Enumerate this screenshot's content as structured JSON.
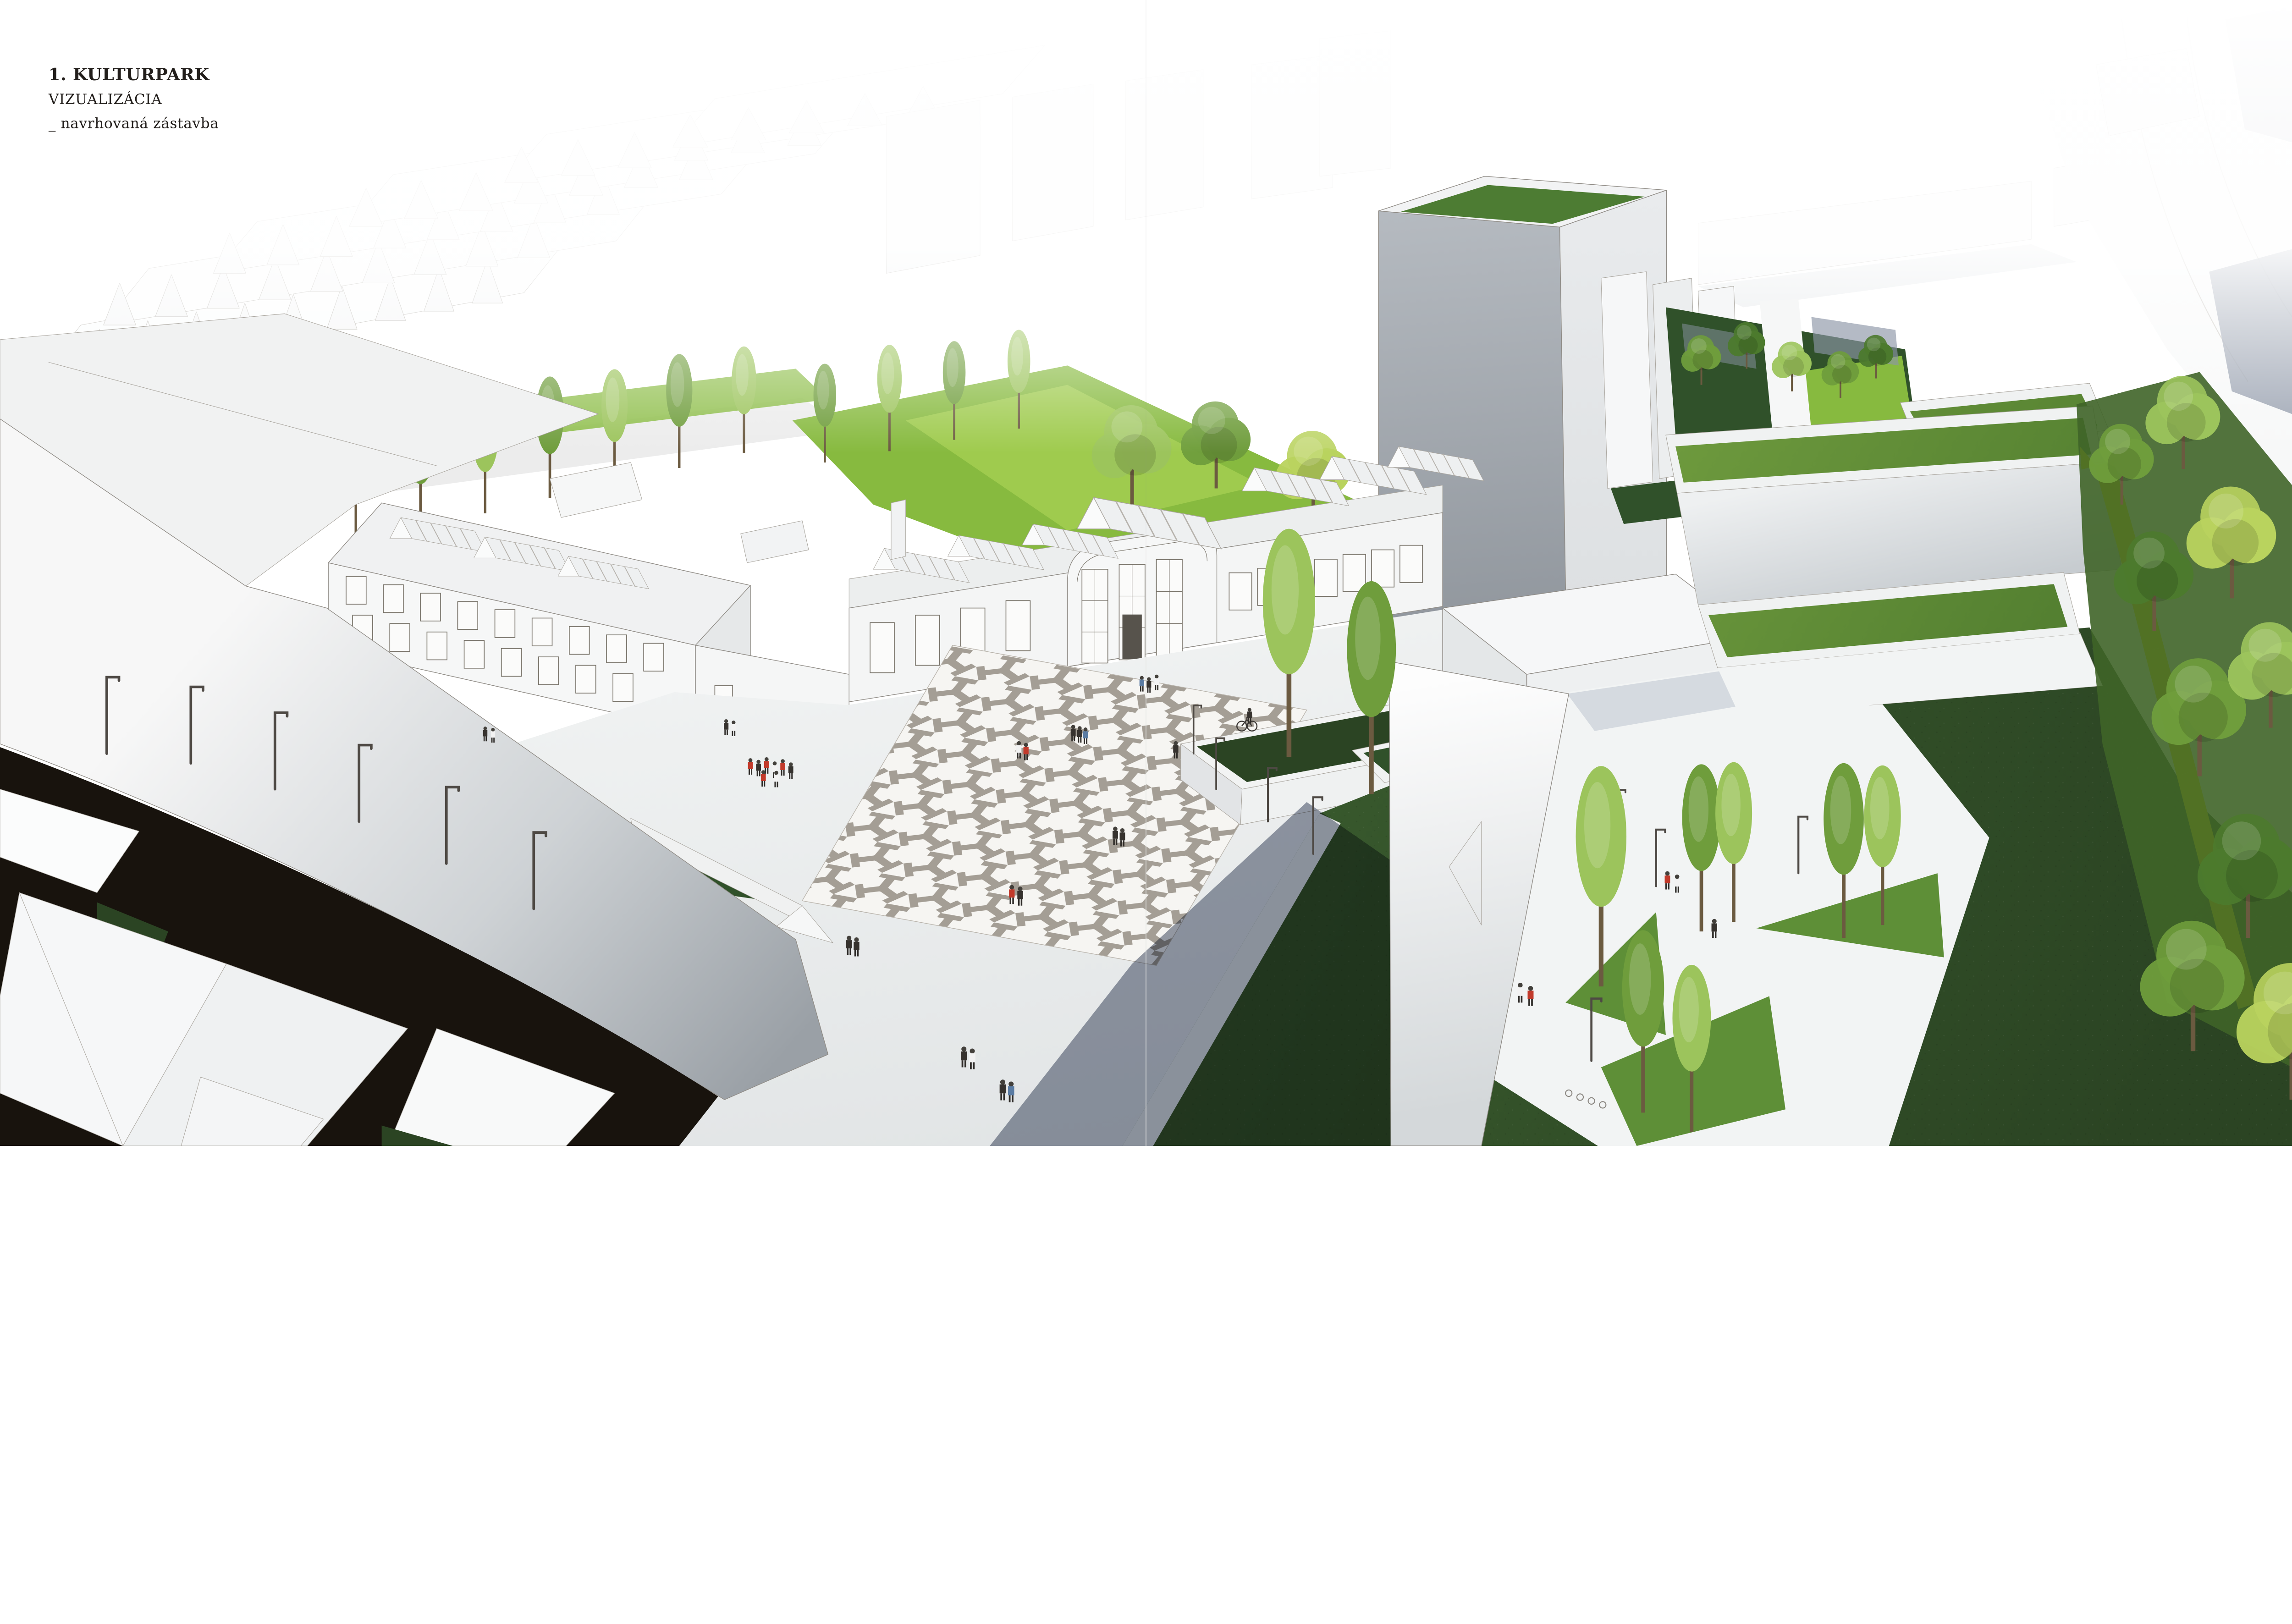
{
  "page": {
    "caption": {
      "number_title": "1. KULTURPARK",
      "line2": "VIZUALIZÁCIA",
      "line3": "_ navrhovaná zástavba"
    }
  },
  "scene": {
    "type": "architectural-aerial-visualization",
    "project": "Kulturpark",
    "elements": [
      "white massing city blocks",
      "industrial halls with sawtooth skylights",
      "grand hall with arched facade",
      "geometric patterned plaza",
      "high-rise tower with green roof",
      "green-roof slabs",
      "dark lawns",
      "sunken courtyard with slender trees",
      "yellow pedestrian path",
      "tree line",
      "street lamps",
      "pedestrians",
      "cyclist",
      "page fold line"
    ]
  },
  "palette": {
    "paper": "#ffffff",
    "ink": "#221e1b",
    "outline": "#8f8b85",
    "face_light": "#f5f6f6",
    "face_mid": "#e7e9ea",
    "face_shade": "#cdd1d4",
    "pavement": "#eef0f0",
    "pattern_bg": "#f6f5f2",
    "pattern_gray": "#a49e95",
    "shadow_blue": "#2f3b55",
    "shadow_cool": "#8c95a6",
    "street_dark": "#18130d",
    "wall_light": "#f7f7f7",
    "wall_dark": "#9aa0a6",
    "tower_top": "#b5bac0",
    "tower_bottom": "#8b9198",
    "tower_side": "#e9ebed",
    "tower_roof": "#4d7c33",
    "lawn_dark_a": "#3a5c2e",
    "lawn_dark_b": "#2b4423",
    "lawn_bright": "#87ba3f",
    "lawn_bright2": "#a9d355",
    "roofgrass_a": "#6f9b3e",
    "roofgrass_b": "#507c2f",
    "hedge": "#30512a",
    "canopy_light": "#9cc45c",
    "canopy_mid": "#6f9d3c",
    "canopy_dark": "#4c7a2d",
    "canopy_yellow": "#b9d35e",
    "yellow": "#f4e800",
    "people_red": "#c23a2b",
    "people_dark": "#36322e"
  }
}
